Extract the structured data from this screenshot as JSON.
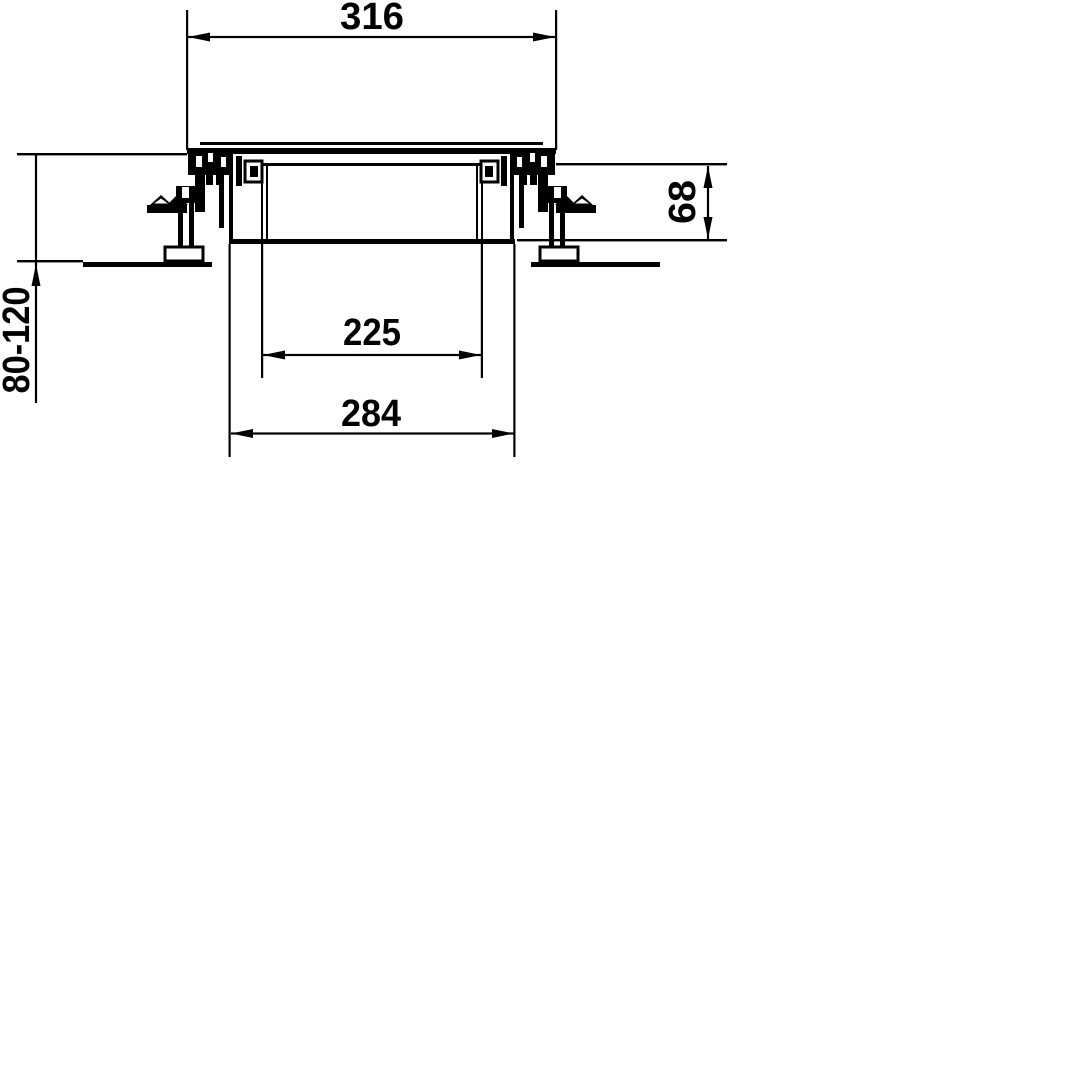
{
  "drawing": {
    "type": "technical-cross-section",
    "subject": "floor-box with leveling feet",
    "colors": {
      "line": "#000000",
      "background": "#ffffff"
    },
    "dimensions": {
      "top_width": {
        "value": "316",
        "orientation": "horizontal"
      },
      "depth": {
        "value": "68",
        "orientation": "vertical"
      },
      "height_range": {
        "value": "80-120",
        "orientation": "vertical"
      },
      "inner_width": {
        "value": "225",
        "orientation": "horizontal"
      },
      "outer_width": {
        "value": "284",
        "orientation": "horizontal"
      }
    }
  }
}
